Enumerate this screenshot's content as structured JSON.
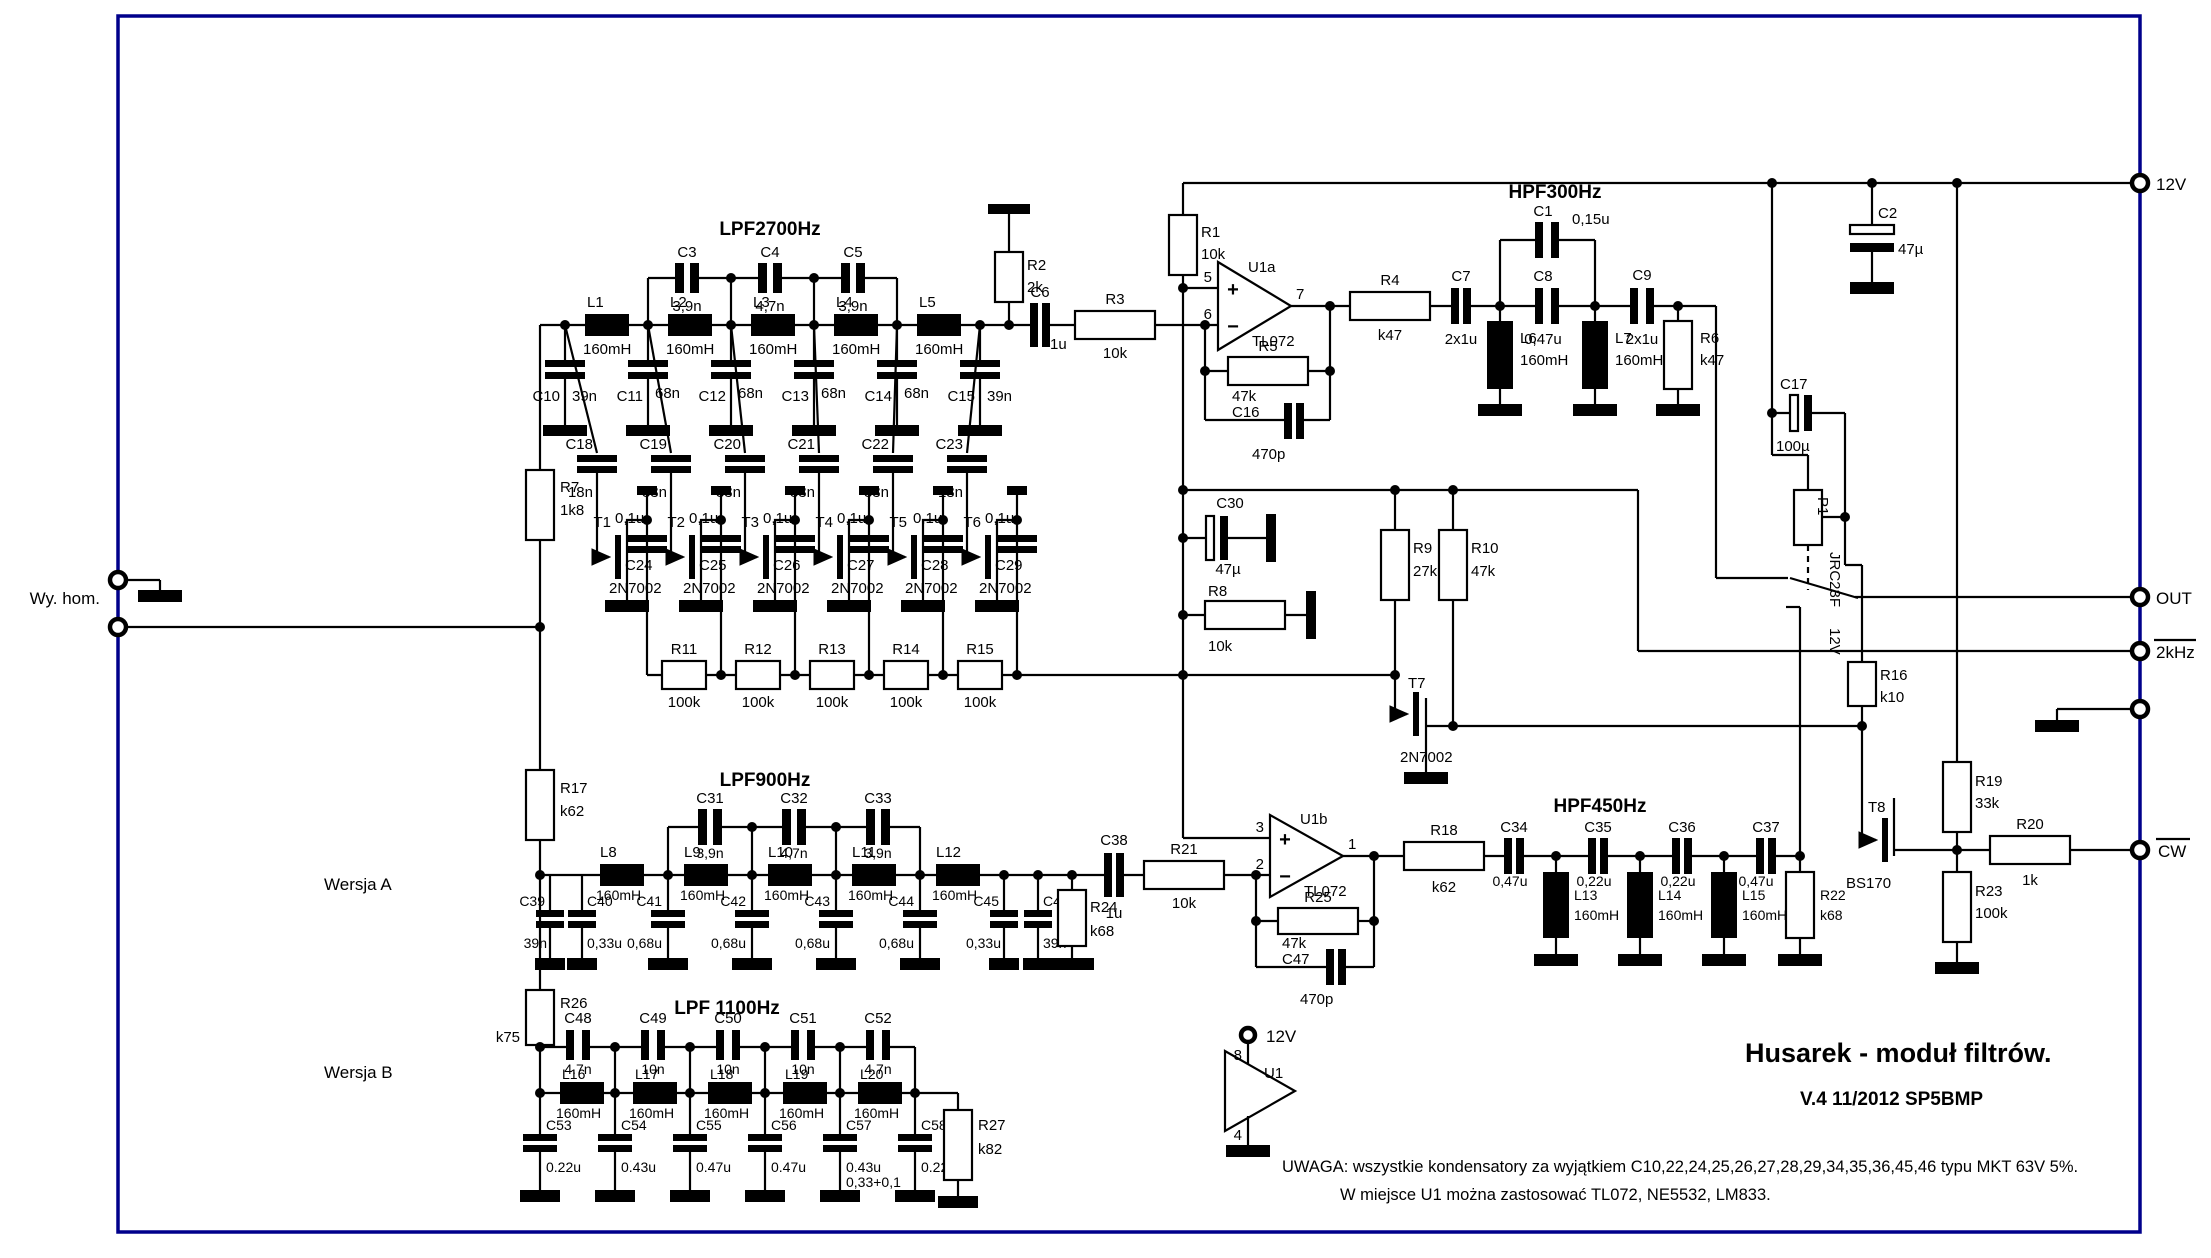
{
  "t": {
    "lpf2700": "LPF2700Hz",
    "hpf300": "HPF300Hz",
    "lpf900": "LPF900Hz",
    "hpf450": "HPF450Hz",
    "lpf1100": "LPF 1100Hz",
    "title": "Husarek - moduł filtrów.",
    "version": "V.4  11/2012   SP5BMP",
    "note1": "UWAGA: wszystkie kondensatory za wyjątkiem C10,22,24,25,26,27,28,29,34,35,36,45,46 typu MKT 63V 5%.",
    "note2": "W miejsce U1 można zastosować TL072, NE5532, LM833.",
    "wy_hom": "Wy. hom.",
    "wersja_a": "Wersja A",
    "wersja_b": "Wersja B",
    "v12": "12V",
    "out": "OUT",
    "khz2": "2kHz",
    "cw": "CW",
    "c57_note": "0,33+0,1",
    "plus": "+",
    "minus": "−"
  },
  "pins": {
    "p1": "1",
    "p2": "2",
    "p3": "3",
    "p4": "4",
    "p5": "5",
    "p6": "6",
    "p7": "7",
    "p8": "8"
  },
  "c": {
    "R1": [
      "R1",
      "10k"
    ],
    "R2": [
      "R2",
      "2k"
    ],
    "R3": [
      "R3",
      "10k"
    ],
    "R4": [
      "R4",
      "k47"
    ],
    "R5": [
      "R5",
      "47k"
    ],
    "R6": [
      "R6",
      "k47"
    ],
    "R7": [
      "R7",
      "1k8"
    ],
    "R8": [
      "R8",
      "10k"
    ],
    "R9": [
      "R9",
      "27k"
    ],
    "R10": [
      "R10",
      "47k"
    ],
    "R11": [
      "R11",
      "100k"
    ],
    "R12": [
      "R12",
      "100k"
    ],
    "R13": [
      "R13",
      "100k"
    ],
    "R14": [
      "R14",
      "100k"
    ],
    "R15": [
      "R15",
      "100k"
    ],
    "R16": [
      "R16",
      "k10"
    ],
    "R17": [
      "R17",
      "k62"
    ],
    "R18": [
      "R18",
      "k62"
    ],
    "R19": [
      "R19",
      "33k"
    ],
    "R20": [
      "R20",
      "1k"
    ],
    "R21": [
      "R21",
      "10k"
    ],
    "R22": [
      "R22",
      "k68"
    ],
    "R23": [
      "R23",
      "100k"
    ],
    "R24": [
      "R24",
      "k68"
    ],
    "R25": [
      "R25",
      "47k"
    ],
    "R26": [
      "R26",
      "k75"
    ],
    "R27": [
      "R27",
      "k82"
    ],
    "C1": [
      "C1",
      "0,15u"
    ],
    "C2": [
      "C2",
      "47µ"
    ],
    "C3": [
      "C3",
      "3,9n"
    ],
    "C4": [
      "C4",
      "4,7n"
    ],
    "C5": [
      "C5",
      "3,9n"
    ],
    "C6": [
      "C6",
      "1u"
    ],
    "C7": [
      "C7",
      "2x1u"
    ],
    "C8": [
      "C8",
      "0,47u"
    ],
    "C9": [
      "C9",
      "2x1u"
    ],
    "C10": [
      "C10",
      "39n"
    ],
    "C11": [
      "C11",
      "68n"
    ],
    "C12": [
      "C12",
      "68n"
    ],
    "C13": [
      "C13",
      "68n"
    ],
    "C14": [
      "C14",
      "68n"
    ],
    "C15": [
      "C15",
      "39n"
    ],
    "C16": [
      "C16",
      "470p"
    ],
    "C17": [
      "C17",
      "100µ"
    ],
    "C18": [
      "C18",
      "18n"
    ],
    "C19": [
      "C19",
      "33n"
    ],
    "C20": [
      "C20",
      "33n"
    ],
    "C21": [
      "C21",
      "33n"
    ],
    "C22": [
      "C22",
      "33n"
    ],
    "C23": [
      "C23",
      "18n"
    ],
    "C24": [
      "C24",
      "0,1u"
    ],
    "C25": [
      "C25",
      "0,1u"
    ],
    "C26": [
      "C26",
      "0,1u"
    ],
    "C27": [
      "C27",
      "0,1u"
    ],
    "C28": [
      "C28",
      "0,1u"
    ],
    "C29": [
      "C29",
      "0,1u"
    ],
    "C30": [
      "C30",
      "47µ"
    ],
    "C31": [
      "C31",
      "3,9n"
    ],
    "C32": [
      "C32",
      "4,7n"
    ],
    "C33": [
      "C33",
      "3,9n"
    ],
    "C34": [
      "C34",
      "0,47u"
    ],
    "C35": [
      "C35",
      "0,22u"
    ],
    "C36": [
      "C36",
      "0,22u"
    ],
    "C37": [
      "C37",
      "0,47u"
    ],
    "C38": [
      "C38",
      "1u"
    ],
    "C39": [
      "C39",
      "39n"
    ],
    "C40": [
      "C40",
      "0,33u"
    ],
    "C41": [
      "C41",
      "0,68u"
    ],
    "C42": [
      "C42",
      "0,68u"
    ],
    "C43": [
      "C43",
      "0,68u"
    ],
    "C44": [
      "C44",
      "0,68u"
    ],
    "C45": [
      "C45",
      "0,33u"
    ],
    "C46": [
      "C46",
      "39n"
    ],
    "C47": [
      "C47",
      "470p"
    ],
    "C48": [
      "C48",
      "4.7n"
    ],
    "C49": [
      "C49",
      "10n"
    ],
    "C50": [
      "C50",
      "10n"
    ],
    "C51": [
      "C51",
      "10n"
    ],
    "C52": [
      "C52",
      "4.7n"
    ],
    "C53": [
      "C53",
      "0.22u"
    ],
    "C54": [
      "C54",
      "0.43u"
    ],
    "C55": [
      "C55",
      "0.47u"
    ],
    "C56": [
      "C56",
      "0.47u"
    ],
    "C57": [
      "C57",
      "0.43u"
    ],
    "C58": [
      "C58",
      "0.22u"
    ],
    "L1": [
      "L1",
      "160mH"
    ],
    "L2": [
      "L2",
      "160mH"
    ],
    "L3": [
      "L3",
      "160mH"
    ],
    "L4": [
      "L4",
      "160mH"
    ],
    "L5": [
      "L5",
      "160mH"
    ],
    "L6": [
      "L6",
      "160mH"
    ],
    "L7": [
      "L7",
      "160mH"
    ],
    "L8": [
      "L8",
      "160mH"
    ],
    "L9": [
      "L9",
      "160mH"
    ],
    "L10": [
      "L10",
      "160mH"
    ],
    "L11": [
      "L11",
      "160mH"
    ],
    "L12": [
      "L12",
      "160mH"
    ],
    "L13": [
      "L13",
      "160mH"
    ],
    "L14": [
      "L14",
      "160mH"
    ],
    "L15": [
      "L15",
      "160mH"
    ],
    "L16": [
      "L16",
      "160mH"
    ],
    "L17": [
      "L17",
      "160mH"
    ],
    "L18": [
      "L18",
      "160mH"
    ],
    "L19": [
      "L19",
      "160mH"
    ],
    "L20": [
      "L20",
      "160mH"
    ],
    "T1": [
      "T1",
      "2N7002"
    ],
    "T2": [
      "T2",
      "2N7002"
    ],
    "T3": [
      "T3",
      "2N7002"
    ],
    "T4": [
      "T4",
      "2N7002"
    ],
    "T5": [
      "T5",
      "2N7002"
    ],
    "T6": [
      "T6",
      "2N7002"
    ],
    "T7": [
      "T7",
      "2N7002"
    ],
    "T8": [
      "T8",
      "BS170"
    ],
    "U1a": [
      "U1a",
      "TL072"
    ],
    "U1b": [
      "U1b",
      "TL072"
    ],
    "U1": [
      "U1"
    ],
    "P1": [
      "P1",
      "JRC23F",
      "12V"
    ]
  }
}
